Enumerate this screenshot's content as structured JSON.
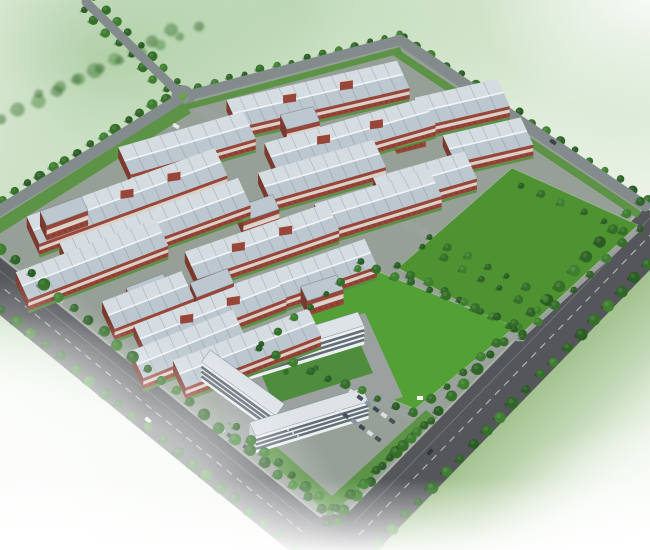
{
  "meta": {
    "description": "Aerial perspective architectural rendering of an industrial park: diagonal rows of long factory workshops with light gray ribbed roofs and red brick walls, two large green lawns, a U-shaped white office building with inner courtyard and parking, tree-lined perimeter roads, and two wide dark avenues meeting at a rounded corner; edges fade into soft white-green atmosphere.",
    "view": "bird's-eye, no text or UI elements visible"
  },
  "palette": {
    "site_base": "#96a097",
    "road_dark": "#54565a",
    "road_curb": "#b9beb8",
    "road_medium": "#848b8d",
    "road_internal": "#9ba29d",
    "lane_line": "rgba(255,255,255,0.55)",
    "lawn": "#4e9231",
    "lawn_bright": "#53a037",
    "green_strip": "#55913e",
    "tree_greens": [
      "#2a5d24",
      "#357029",
      "#3f8030",
      "#2f6628"
    ],
    "tree_shadow": "rgba(18,38,16,0.35)",
    "roof_light": "#d5dde3",
    "roof_dark": "#bcc7cf",
    "roof_ridge": "#f2f5f7",
    "roof_rib": "rgba(95,110,122,0.30)",
    "brick_wall": "#98463a",
    "brick_dark": "#7c392e",
    "wall_band": "#ded8cf",
    "office_wall": "#edf0f1",
    "office_side": "#c3cbd0",
    "office_roof": "#dde3e7",
    "office_window": "#4a5761",
    "courtyard": "#4f8c3e",
    "plaza": "#9aa19e",
    "se_wash": "#7ba860",
    "car_colors": [
      "#d9dee1",
      "#47525c",
      "#8494a0",
      "#3d4854"
    ]
  },
  "scene": {
    "site_outline": [
      [
        183,
        97
      ],
      [
        400,
        40
      ],
      [
        645,
        206
      ],
      [
        333,
        527
      ],
      [
        -32,
        230
      ]
    ],
    "wide_roads": [
      {
        "name": "southwest-avenue",
        "inner": [
          [
            -32,
            230
          ],
          [
            333,
            527
          ]
        ],
        "out_shift": [
          -27.6,
          36.8
        ],
        "lane": [
          [
            -45.8,
            248.4
          ],
          [
            319.2,
            545.4
          ]
        ]
      },
      {
        "name": "southeast-avenue",
        "inner": [
          [
            333,
            527
          ],
          [
            645,
            206
          ]
        ],
        "out_shift": [
          34.5,
          33.4
        ],
        "lane": [
          [
            350,
            544
          ],
          [
            662.2,
            222.7
          ]
        ]
      }
    ],
    "perimeter_roads": [
      {
        "name": "northwest-road",
        "from": [
          183,
          97
        ],
        "to": [
          -32,
          230
        ],
        "w": 11
      },
      {
        "name": "north-road",
        "from": [
          183,
          97
        ],
        "to": [
          400,
          40
        ],
        "w": 10
      },
      {
        "name": "northeast-road",
        "from": [
          400,
          40
        ],
        "to": [
          645,
          206
        ],
        "w": 11
      },
      {
        "name": "exit-road",
        "from": [
          183,
          97
        ],
        "to": [
          86,
          2
        ],
        "w": 9
      }
    ],
    "internal_roads": [
      {
        "name": "main-avenue",
        "from": [
          188,
          102
        ],
        "to": [
          545,
          300
        ],
        "w": 9
      },
      {
        "name": "between-lawns-road",
        "from": [
          392,
          274
        ],
        "to": [
          522,
          338
        ],
        "w": 7
      },
      {
        "name": "lawn1-east-road",
        "from": [
          636,
          230
        ],
        "to": [
          518,
          338
        ],
        "w": 7
      },
      {
        "name": "lawn2-east-road",
        "from": [
          517,
          333
        ],
        "to": [
          417,
          416
        ],
        "w": 7
      },
      {
        "name": "office-approach-road",
        "from": [
          256,
          352
        ],
        "to": [
          420,
          420
        ],
        "w": 8
      }
    ],
    "roundabout": {
      "c": [
        183,
        97
      ],
      "r": 8.5,
      "ring_w": 6.5,
      "center_green": "#6f9e58"
    },
    "lawns": [
      {
        "name": "north-lawn",
        "points": [
          [
            512,
            168
          ],
          [
            638,
            225
          ],
          [
            520,
            335
          ],
          [
            398,
            268
          ]
        ],
        "bright": false
      },
      {
        "name": "sports-lawn",
        "points": [
          [
            362,
            265
          ],
          [
            515,
            327
          ],
          [
            415,
            409
          ],
          [
            262,
            345
          ]
        ],
        "bright": true
      }
    ],
    "green_bands": [
      {
        "name": "nw-hedge",
        "points": [
          [
            183,
            103
          ],
          [
            -28,
            236
          ],
          [
            -20,
            246
          ],
          [
            191,
            113
          ]
        ]
      },
      {
        "name": "north-hedge",
        "points": [
          [
            185,
            104
          ],
          [
            400,
            47
          ],
          [
            402,
            53
          ],
          [
            187,
            110
          ]
        ]
      },
      {
        "name": "ne-hedge",
        "points": [
          [
            399,
            50
          ],
          [
            642,
            212
          ],
          [
            637,
            218
          ],
          [
            394,
            56
          ]
        ]
      },
      {
        "name": "corner-strip-west",
        "points": [
          [
            228,
            423
          ],
          [
            330,
            516
          ],
          [
            342,
            505
          ],
          [
            240,
            414
          ]
        ]
      },
      {
        "name": "corner-strip-east",
        "points": [
          [
            330,
            516
          ],
          [
            436,
            418
          ],
          [
            426,
            410
          ],
          [
            320,
            507
          ]
        ]
      }
    ],
    "sheds": [
      {
        "c": [
          318,
          94
        ],
        "len": 175,
        "ang": -13,
        "towers": 2
      },
      {
        "c": [
          462,
          102
        ],
        "len": 85,
        "ang": -13,
        "towers": 0
      },
      {
        "c": [
          488,
          140
        ],
        "len": 80,
        "ang": -13,
        "towers": 0
      },
      {
        "c": [
          350,
          134
        ],
        "len": 165,
        "ang": -16,
        "towers": 2
      },
      {
        "c": [
          187,
          143
        ],
        "len": 130,
        "ang": -16,
        "towers": 0
      },
      {
        "c": [
          127,
          196
        ],
        "len": 200,
        "ang": -20,
        "towers": 3
      },
      {
        "c": [
          155,
          224
        ],
        "len": 190,
        "ang": -20,
        "towers": 0
      },
      {
        "c": [
          92,
          259
        ],
        "len": 150,
        "ang": -21,
        "towers": 0
      },
      {
        "c": [
          262,
          241
        ],
        "len": 150,
        "ang": -19,
        "towers": 2
      },
      {
        "c": [
          300,
          277
        ],
        "len": 150,
        "ang": -19,
        "towers": 0
      },
      {
        "c": [
          210,
          312
        ],
        "len": 150,
        "ang": -21,
        "towers": 2
      },
      {
        "c": [
          247,
          348
        ],
        "len": 145,
        "ang": -21,
        "towers": 0
      },
      {
        "c": [
          378,
          200
        ],
        "len": 120,
        "ang": -17,
        "towers": 0
      },
      {
        "c": [
          188,
          344
        ],
        "len": 110,
        "ang": -22,
        "towers": 0
      },
      {
        "c": [
          322,
          170
        ],
        "len": 120,
        "ang": -16,
        "towers": 0
      },
      {
        "c": [
          148,
          300
        ],
        "len": 85,
        "ang": -21,
        "towers": 0
      },
      {
        "c": [
          425,
          178
        ],
        "len": 95,
        "ang": -16,
        "towers": 0
      }
    ],
    "red_blocks": [
      {
        "c": [
          64,
          211
        ],
        "len": 44,
        "ang": -20
      },
      {
        "c": [
          148,
          288
        ],
        "len": 40,
        "ang": -21
      },
      {
        "c": [
          212,
          283
        ],
        "len": 40,
        "ang": -21
      },
      {
        "c": [
          258,
          208
        ],
        "len": 38,
        "ang": -19
      },
      {
        "c": [
          322,
          288
        ],
        "len": 38,
        "ang": -18
      },
      {
        "c": [
          300,
          118
        ],
        "len": 34,
        "ang": -14
      },
      {
        "c": [
          408,
          128
        ],
        "len": 30,
        "ang": -14
      }
    ],
    "office": {
      "plaza": [
        [
          203,
          363
        ],
        [
          365,
          313
        ],
        [
          403,
          397
        ],
        [
          241,
          447
        ]
      ],
      "courtyard": [
        [
          253,
          355
        ],
        [
          352,
          325
        ],
        [
          373,
          373
        ],
        [
          274,
          404
        ]
      ],
      "slabs": [
        {
          "c": [
            298,
            338
          ],
          "len": 132,
          "ang": -17,
          "dep": 15,
          "h": 19,
          "dir": "dr"
        },
        {
          "c": [
            243,
            383
          ],
          "len": 92,
          "ang": 36,
          "dep": 15,
          "h": 19,
          "dir": "ur"
        },
        {
          "c": [
            309,
            412
          ],
          "len": 118,
          "ang": -17,
          "dep": 15,
          "h": 17,
          "dir": "dr"
        }
      ],
      "bushes": [
        [
          300,
          360
        ],
        [
          316,
          368
        ],
        [
          286,
          372
        ]
      ]
    },
    "parking_rows": [
      {
        "start": [
          352,
          392
        ],
        "step": [
          8,
          5.8
        ],
        "count": 6
      },
      {
        "start": [
          338,
          410
        ],
        "step": [
          8,
          5.8
        ],
        "count": 6
      },
      {
        "start": [
          222,
          430
        ],
        "step": [
          8,
          5.8
        ],
        "count": 4
      }
    ],
    "tree_rows": [
      {
        "a": [
          0,
          120
        ],
        "b": [
          170,
          30
        ],
        "n": 10,
        "r": 6,
        "layer": "back",
        "ghost": true
      },
      {
        "a": [
          40,
          95
        ],
        "b": [
          200,
          28
        ],
        "n": 9,
        "r": 5,
        "layer": "back",
        "ghost": true
      },
      {
        "a": [
          83,
          9
        ],
        "b": [
          178,
          102
        ],
        "n": 9,
        "r": 4,
        "layer": "back",
        "ghost": false
      },
      {
        "a": [
          93,
          -2
        ],
        "b": [
          188,
          92
        ],
        "n": 9,
        "r": 4,
        "layer": "back",
        "ghost": false
      },
      {
        "a": [
          179,
          90
        ],
        "b": [
          -36,
          223
        ],
        "n": 18,
        "r": 4.5,
        "layer": "back",
        "ghost": false
      },
      {
        "a": [
          187,
          104
        ],
        "b": [
          -28,
          237
        ],
        "n": 18,
        "r": 4.5,
        "layer": "back",
        "ghost": false
      },
      {
        "a": [
          183,
          90
        ],
        "b": [
          400,
          33
        ],
        "n": 15,
        "r": 3.5,
        "layer": "back",
        "ghost": false
      },
      {
        "a": [
          403,
          36
        ],
        "b": [
          648,
          199
        ],
        "n": 18,
        "r": 4,
        "layer": "back",
        "ghost": false
      },
      {
        "a": [
          397,
          48
        ],
        "b": [
          639,
          211
        ],
        "n": 17,
        "r": 4,
        "layer": "back",
        "ghost": false
      },
      {
        "a": [
          -56,
          262
        ],
        "b": [
          309,
          559
        ],
        "n": 26,
        "r": 5,
        "layer": "front",
        "ghost": false
      },
      {
        "a": [
          -28,
          225
        ],
        "b": [
          337,
          522
        ],
        "n": 26,
        "r": 5,
        "layer": "front",
        "ghost": false
      },
      {
        "a": [
          364,
          557
        ],
        "b": [
          676,
          235
        ],
        "n": 24,
        "r": 5,
        "layer": "front",
        "ghost": false
      },
      {
        "a": [
          329,
          523
        ],
        "b": [
          641,
          201
        ],
        "n": 24,
        "r": 5,
        "layer": "front",
        "ghost": false
      },
      {
        "a": [
          430,
          236
        ],
        "b": [
          545,
          298
        ],
        "n": 7,
        "r": 3.5,
        "layer": "front",
        "ghost": false
      },
      {
        "a": [
          424,
          248
        ],
        "b": [
          538,
          310
        ],
        "n": 7,
        "r": 3.5,
        "layer": "front",
        "ghost": false
      },
      {
        "a": [
          396,
          266
        ],
        "b": [
          524,
          334
        ],
        "n": 9,
        "r": 4,
        "layer": "front",
        "ghost": false
      },
      {
        "a": [
          360,
          262
        ],
        "b": [
          514,
          324
        ],
        "n": 10,
        "r": 4,
        "layer": "front",
        "ghost": false
      },
      {
        "a": [
          640,
          228
        ],
        "b": [
          522,
          337
        ],
        "n": 8,
        "r": 4,
        "layer": "front",
        "ghost": false
      },
      {
        "a": [
          515,
          330
        ],
        "b": [
          413,
          413
        ],
        "n": 7,
        "r": 4,
        "layer": "front",
        "ghost": false
      },
      {
        "a": [
          260,
          349
        ],
        "b": [
          413,
          413
        ],
        "n": 10,
        "r": 4,
        "layer": "front",
        "ghost": false
      },
      {
        "a": [
          262,
          344
        ],
        "b": [
          358,
          268
        ],
        "n": 7,
        "r": 3.5,
        "layer": "front",
        "ghost": false
      },
      {
        "a": [
          237,
          428
        ],
        "b": [
          333,
          508
        ],
        "n": 8,
        "r": 4.5,
        "layer": "front",
        "ghost": false
      },
      {
        "a": [
          336,
          508
        ],
        "b": [
          432,
          420
        ],
        "n": 8,
        "r": 4.5,
        "layer": "front",
        "ghost": false
      },
      {
        "a": [
          520,
          185
        ],
        "b": [
          625,
          230
        ],
        "n": 6,
        "r": 3.5,
        "layer": "front",
        "ghost": false
      }
    ],
    "cars_on_roads": [
      {
        "p": [
          176,
          126
        ],
        "rot": 30,
        "color": "#e8e8e6"
      },
      {
        "p": [
          553,
          142
        ],
        "rot": 33,
        "color": "#3c4145"
      },
      {
        "p": [
          148,
          420
        ],
        "rot": 40,
        "color": "#e8e8e6"
      },
      {
        "p": [
          430,
          452
        ],
        "rot": -46,
        "color": "#30373c"
      },
      {
        "p": [
          60,
          300
        ],
        "rot": 40,
        "color": "#d8d8d4"
      }
    ],
    "props": {
      "sign": {
        "p": [
          420,
          398
        ],
        "w": 6,
        "h": 4,
        "color": "#f2f4f4"
      },
      "flag_dots": [
        [
          288,
          430
        ],
        [
          293,
          433
        ],
        [
          298,
          436
        ]
      ]
    }
  }
}
